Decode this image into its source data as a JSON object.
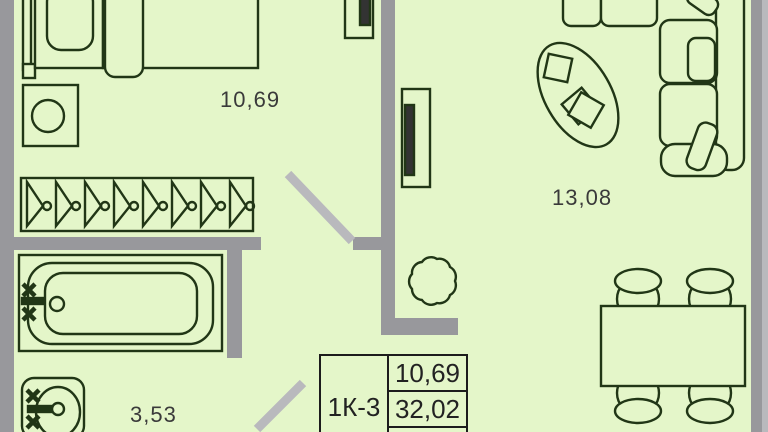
{
  "title": "Apartment floor plan",
  "rooms": {
    "bedroom_area": "10,69",
    "living_area": "13,08",
    "bathroom_area": "3,53"
  },
  "legend": {
    "unit_type": "1К-3",
    "row1_area": "10,69",
    "row2_area": "32,02"
  },
  "colors": {
    "floor": "#e4f6c9",
    "wall": "#98989c",
    "wall_light": "#b9b9bd",
    "door_leaf": "#b9b9bd",
    "outline": "#213616",
    "label_text": "#3a3a3a",
    "legend_border": "#1c1c1c"
  },
  "furniture": [
    "bed",
    "washing-machine",
    "wardrobe-hangers",
    "radiator-bedroom",
    "radiator-living",
    "bathtub",
    "sink",
    "sofa",
    "coffee-table",
    "plant",
    "dining-table",
    "dining-chairs"
  ]
}
